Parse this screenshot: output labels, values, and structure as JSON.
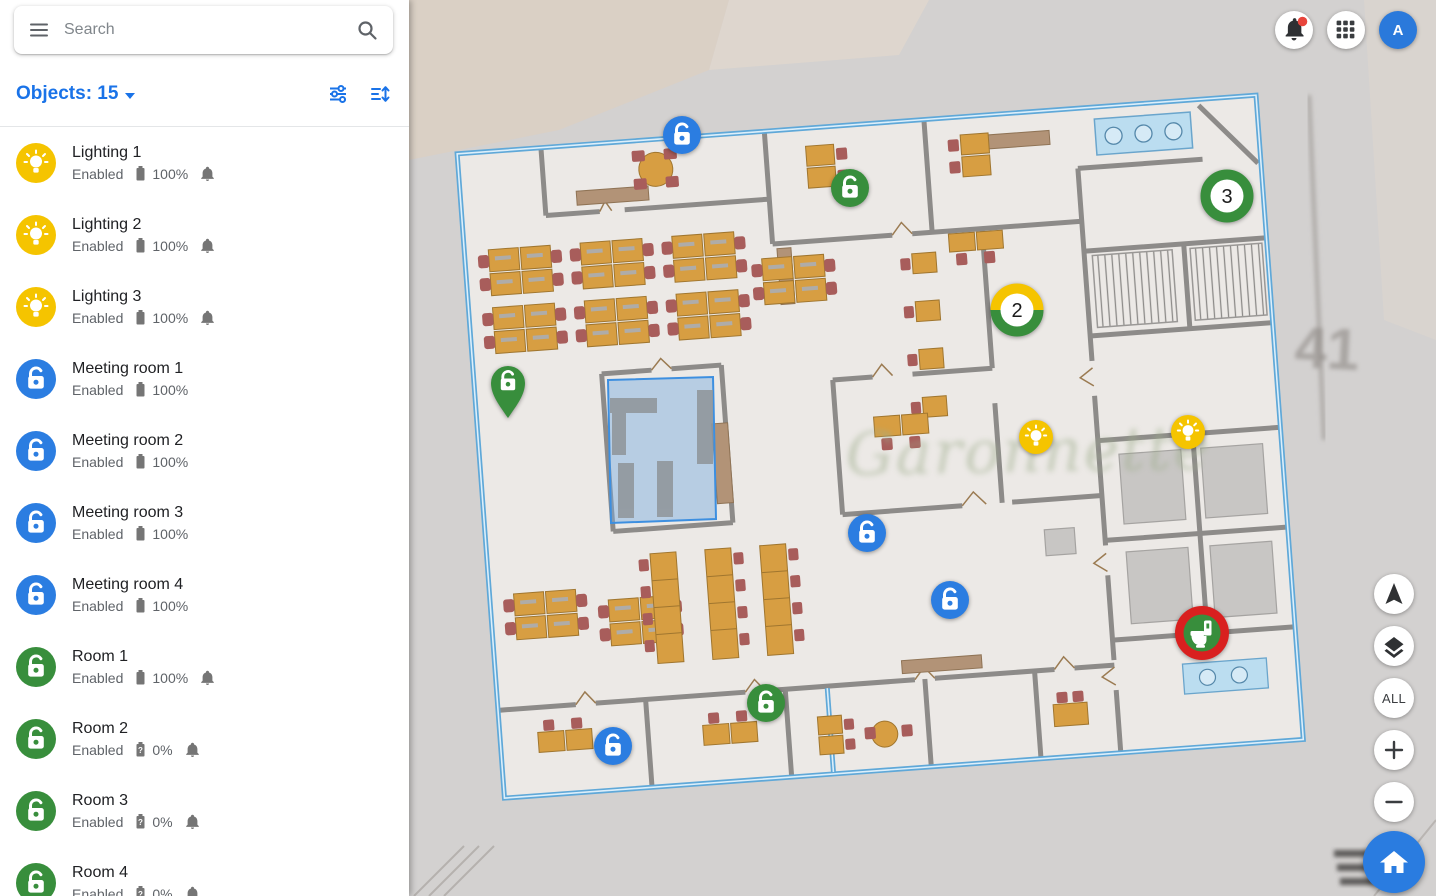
{
  "search": {
    "placeholder": "Search"
  },
  "objects_header": {
    "label": "Objects: 15"
  },
  "topbar": {
    "avatar_letter": "A"
  },
  "sidebar": {
    "battery_unknown_glyph": "?",
    "items": [
      {
        "name": "Lighting 1",
        "status": "Enabled",
        "battery": "100%"
      },
      {
        "name": "Lighting 2",
        "status": "Enabled",
        "battery": "100%"
      },
      {
        "name": "Lighting 3",
        "status": "Enabled",
        "battery": "100%"
      },
      {
        "name": "Meeting room 1",
        "status": "Enabled",
        "battery": "100%"
      },
      {
        "name": "Meeting room 2",
        "status": "Enabled",
        "battery": "100%"
      },
      {
        "name": "Meeting room 3",
        "status": "Enabled",
        "battery": "100%"
      },
      {
        "name": "Meeting room 4",
        "status": "Enabled",
        "battery": "100%"
      },
      {
        "name": "Room 1",
        "status": "Enabled",
        "battery": "100%"
      },
      {
        "name": "Room 2",
        "status": "Enabled",
        "battery": "0%"
      },
      {
        "name": "Room 3",
        "status": "Enabled",
        "battery": "0%"
      },
      {
        "name": "Room 4",
        "status": "Enabled",
        "battery": "0%"
      }
    ]
  },
  "map": {
    "watermark": "Garonnette",
    "parcel_number": "41",
    "clusters": {
      "cluster_a": "2",
      "cluster_b": "3"
    },
    "controls": {
      "all_label": "ALL"
    }
  },
  "colors": {
    "accent_blue": "#1A73E8",
    "marker_blue": "#2B7DE1",
    "marker_green": "#388E3C",
    "marker_yellow": "#F5C400",
    "marker_red": "#D9201F",
    "selection_blue": "#3D8FE0",
    "white": "#FFFFFF"
  }
}
